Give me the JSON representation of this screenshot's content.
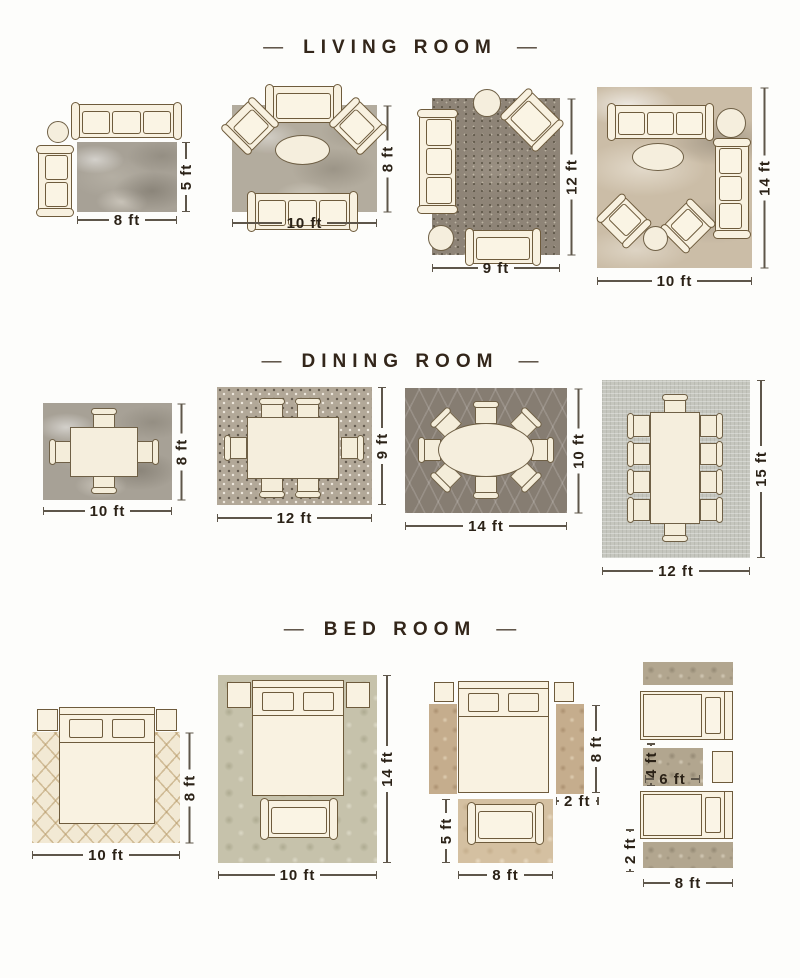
{
  "decor": {
    "dash": "—"
  },
  "colors": {
    "background": "#fdfdfb",
    "title_text": "#33261a",
    "furniture_fill": "#f8f1e0",
    "furniture_outline": "#6e5b3c",
    "dimension_text": "#2b2217",
    "dimension_line": "#5e564a"
  },
  "sections": [
    {
      "title": "LIVING ROOM",
      "layouts": [
        {
          "name": "living-8x5",
          "width": "8 ft",
          "height": "5 ft"
        },
        {
          "name": "living-10x8",
          "width": "10 ft",
          "height": "8 ft"
        },
        {
          "name": "living-9x12",
          "width": "9 ft",
          "height": "12 ft"
        },
        {
          "name": "living-10x14",
          "width": "10 ft",
          "height": "14 ft"
        }
      ]
    },
    {
      "title": "DINING ROOM",
      "layouts": [
        {
          "name": "dining-10x8",
          "width": "10 ft",
          "height": "8 ft"
        },
        {
          "name": "dining-12x9",
          "width": "12 ft",
          "height": "9 ft"
        },
        {
          "name": "dining-14x10",
          "width": "14 ft",
          "height": "10 ft"
        },
        {
          "name": "dining-12x15",
          "width": "12 ft",
          "height": "15 ft"
        }
      ]
    },
    {
      "title": "BED ROOM",
      "layouts": [
        {
          "name": "bed-10x8",
          "width": "10 ft",
          "height": "8 ft"
        },
        {
          "name": "bed-10x14",
          "width": "10 ft",
          "height": "14 ft"
        },
        {
          "name": "bed-runners",
          "bed_rug_height": "8 ft",
          "runner_width": "2 ft",
          "seating_rug_height": "5 ft",
          "seating_rug_width": "8 ft"
        },
        {
          "name": "bed-twin",
          "accent_rug_height": "4 ft",
          "accent_rug_width": "6 ft",
          "runner_height": "2 ft",
          "runner_width": "8 ft"
        }
      ]
    }
  ]
}
